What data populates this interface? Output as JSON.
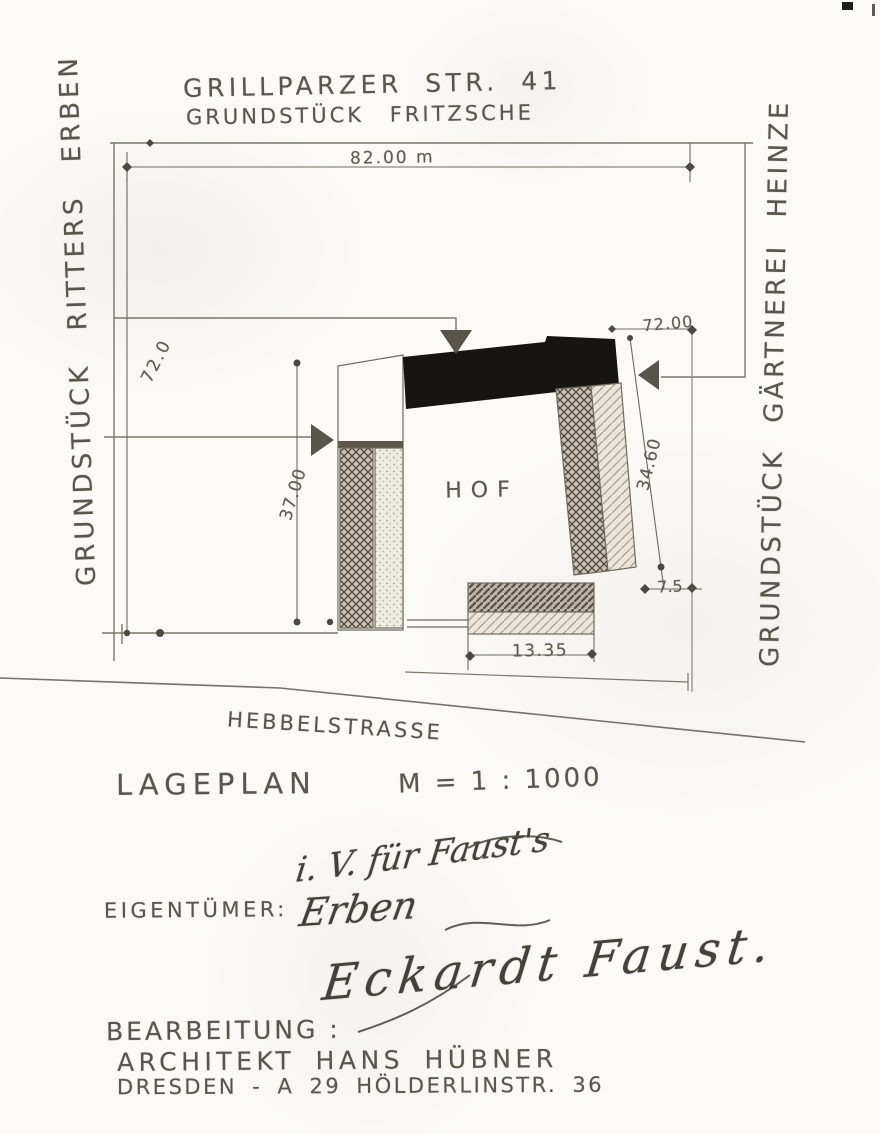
{
  "header": {
    "line1": "GRILLPARZER STR. 41",
    "line2": "GRUNDSTÜCK FRITZSCHE"
  },
  "site": {
    "west_neighbor": "GRUNDSTÜCK RITTERS ERBEN",
    "east_neighbor": "GRUNDSTÜCK GÄRTNEREI HEINZE",
    "courtyard": "HOF",
    "street": "HEBBELSTRASSE"
  },
  "dimensions": {
    "frontage": "82.00 m",
    "depth_west": "72.0",
    "depth_east": "72.00",
    "inner_west": "37.00",
    "inner_east": "34.60",
    "offset_east": "7.5",
    "rear_width": "13.35"
  },
  "titleblock": {
    "type": "LAGEPLAN",
    "scale": "M = 1 : 1000"
  },
  "owner": {
    "label": "EIGENTÜMER:",
    "hand1": "i. V. für Faust's",
    "hand2": "Erben",
    "hand3": "Eckardt Faust."
  },
  "author": {
    "label": "BEARBEITUNG :",
    "name": "ARCHITEKT HANS HÜBNER",
    "address": "DRESDEN - A 29 HÖLDERLINSTR. 36"
  }
}
